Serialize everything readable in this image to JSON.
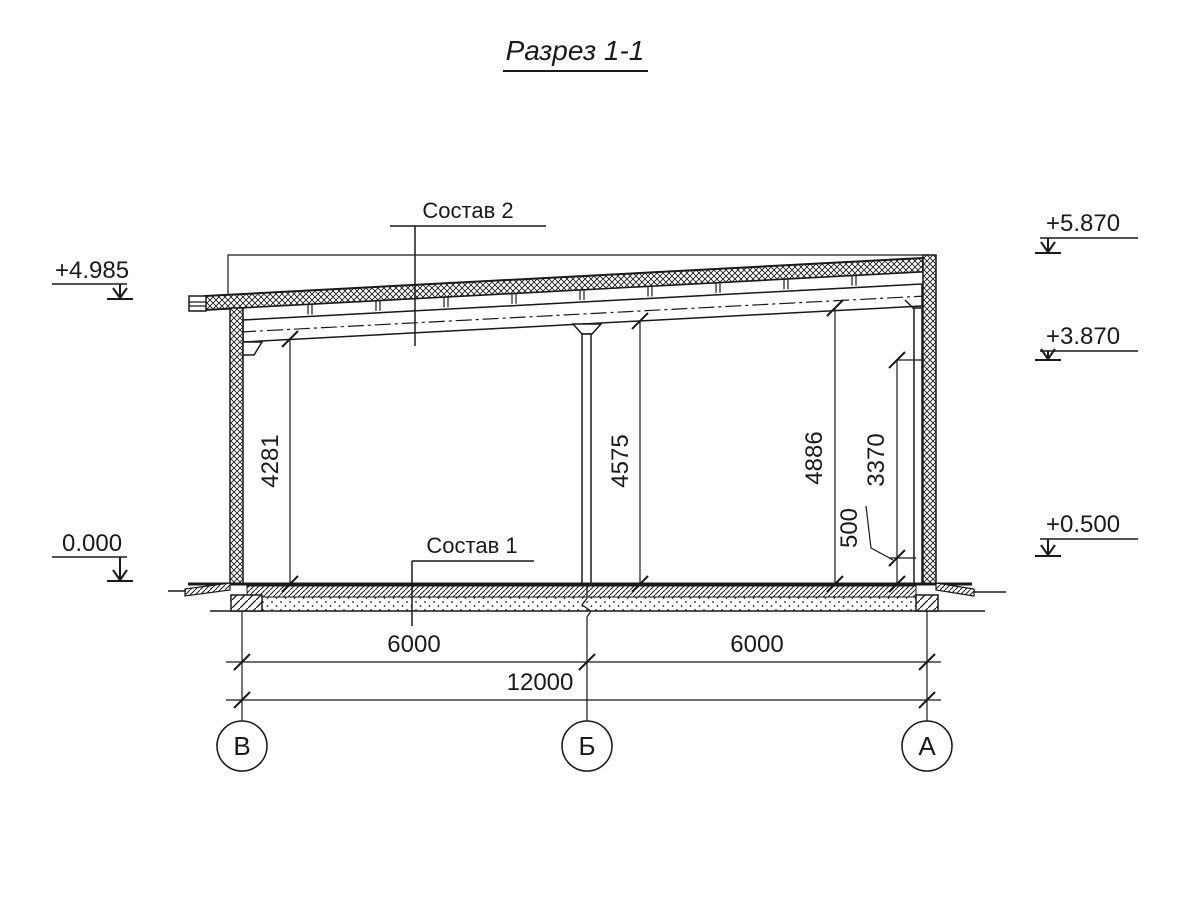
{
  "drawing": {
    "title": "Разрез 1-1"
  },
  "colors": {
    "line": "#1a1a1a",
    "background": "#ffffff"
  },
  "labels": {
    "roof_composition": "Состав 2",
    "floor_composition": "Состав 1"
  },
  "elevations": {
    "left_top": "+4.985",
    "left_zero": "0.000",
    "right_top": "+5.870",
    "right_mid": "+3.870",
    "right_low": "+0.500"
  },
  "vertical_dims": {
    "left_clear": "4281",
    "mid_clear": "4575",
    "right_clear": "4886",
    "right_upper": "3370",
    "right_plinth": "500"
  },
  "horizontal_dims": {
    "span_left": "6000",
    "span_right": "6000",
    "total": "12000"
  },
  "axes": {
    "left": "В",
    "middle": "Б",
    "right": "А"
  }
}
